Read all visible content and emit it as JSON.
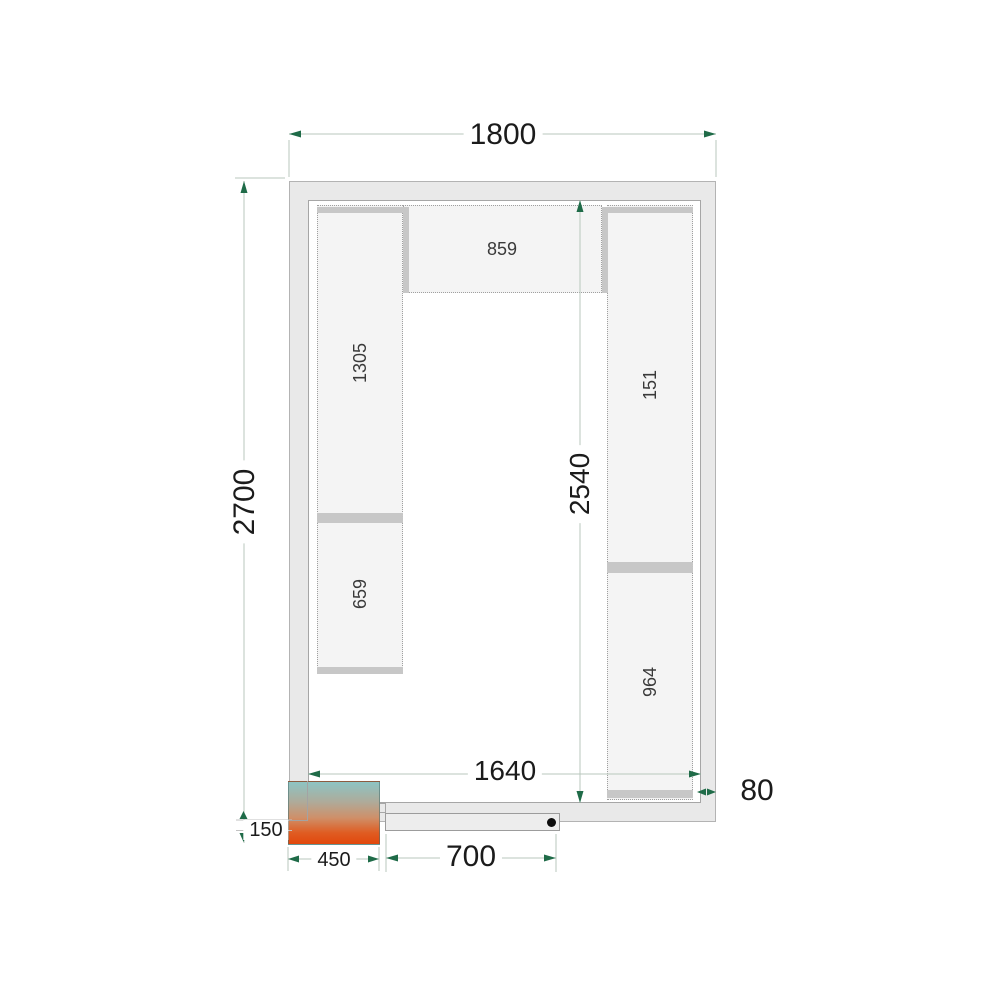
{
  "dimensions": {
    "overall_width": "1800",
    "overall_depth": "2700",
    "inner_depth": "2540",
    "inner_width": "1640",
    "panel_thickness": "80",
    "cooling_unit_width": "450",
    "cooling_unit_protrusion": "150",
    "door_width": "700"
  },
  "shelf_labels": {
    "top": "859",
    "left_upper": "1305",
    "left_lower": "659",
    "right_upper": "151",
    "right_lower": "964"
  },
  "colors": {
    "dimension_arrow": "#1f6b48",
    "dimension_line": "#b9c7bc",
    "wall_fill": "#e9e9e9",
    "wall_border": "#a6a6a6",
    "shelf_fill": "#f4f4f4",
    "shelf_bar": "#c7c7c7",
    "cooling_unit_top": "#8dc4c3",
    "cooling_unit_bottom": "#e2470c",
    "door_dot": "#0d0d0d"
  }
}
